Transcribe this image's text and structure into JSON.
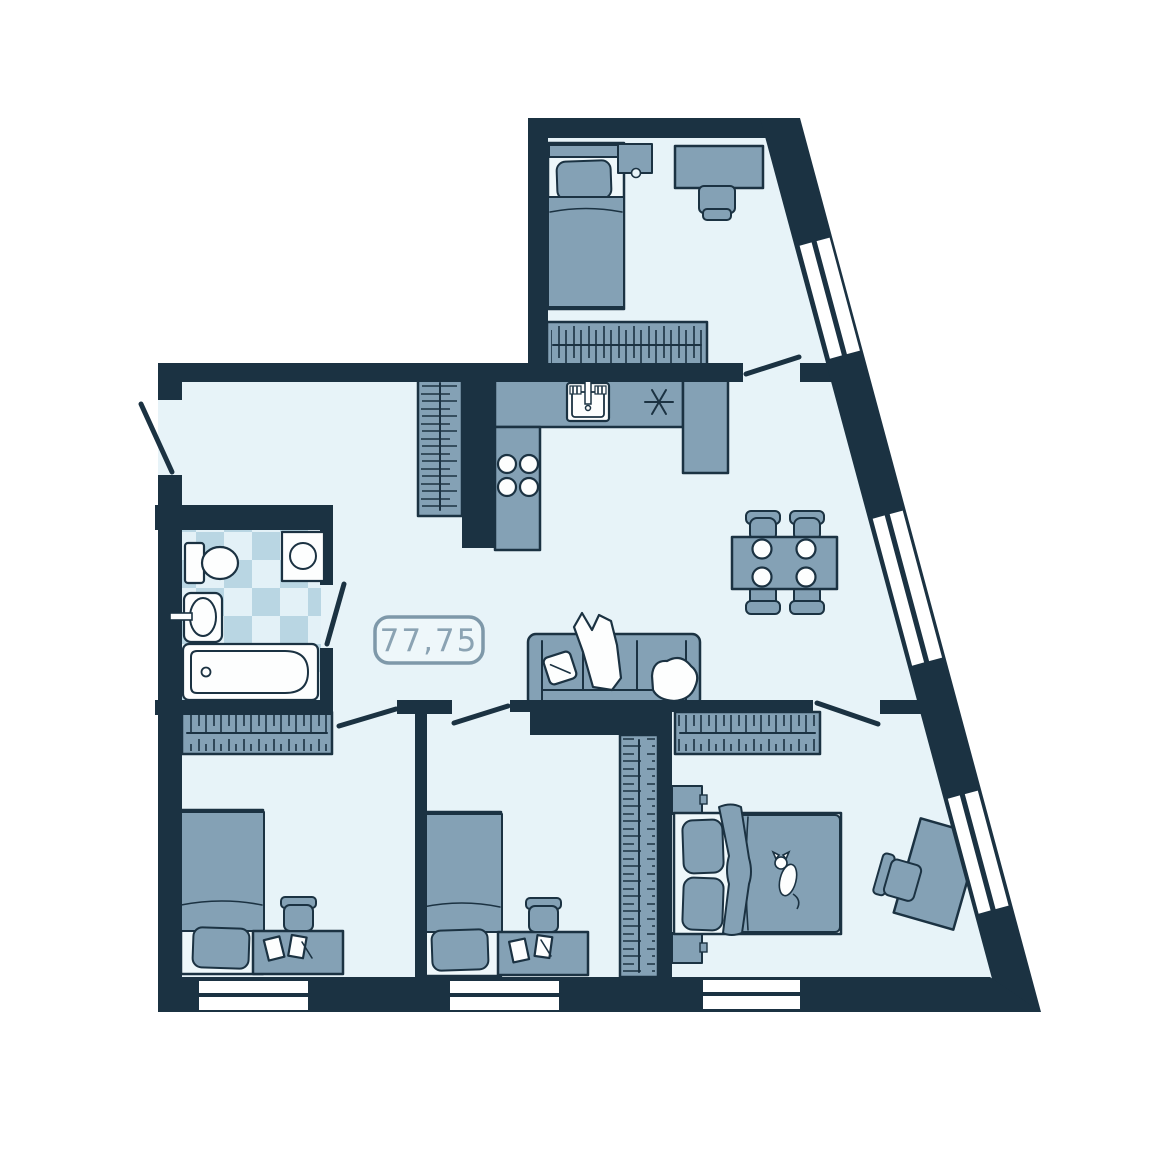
{
  "floor_plan": {
    "area_label": "77,75",
    "colors": {
      "wall": "#1b3242",
      "floor": "#e7f3f8",
      "furniture": "#84a1b5",
      "fixture_white": "#fdfefe",
      "tile_blue": "#b9d6e3",
      "tile_light": "#e3f1f7",
      "label_border": "#7e98a9",
      "label_text": "#8ba3b3",
      "label_bg": "#eef7fa"
    },
    "rooms": [
      {
        "name": "bedroom-top",
        "items": [
          "single-bed",
          "pillow",
          "blanket",
          "nightstand",
          "desk",
          "chair",
          "wardrobe",
          "slant-window"
        ]
      },
      {
        "name": "living-kitchen",
        "items": [
          "kitchen-counter",
          "kitchen-sink",
          "cooktop-symbol",
          "stove-burners",
          "hall-wardrobe",
          "dining-table",
          "dining-chairs",
          "plates",
          "sofa",
          "sofa-pillow",
          "throw-blanket",
          "slant-window"
        ]
      },
      {
        "name": "bathroom",
        "items": [
          "toilet",
          "washing-machine",
          "basin",
          "bathtub",
          "tiled-floor"
        ]
      },
      {
        "name": "bedroom-left",
        "items": [
          "wardrobe",
          "single-bed",
          "pillow",
          "desk",
          "chair",
          "papers",
          "window"
        ]
      },
      {
        "name": "bedroom-middle",
        "items": [
          "single-bed",
          "pillow",
          "desk",
          "chair",
          "papers",
          "wardrobe",
          "window"
        ]
      },
      {
        "name": "bedroom-master",
        "items": [
          "wardrobe",
          "double-bed",
          "pillows",
          "blanket",
          "cat",
          "nightstands",
          "desk",
          "chair",
          "slant-window",
          "window"
        ]
      }
    ],
    "window_count": 6,
    "door_count": 6
  }
}
